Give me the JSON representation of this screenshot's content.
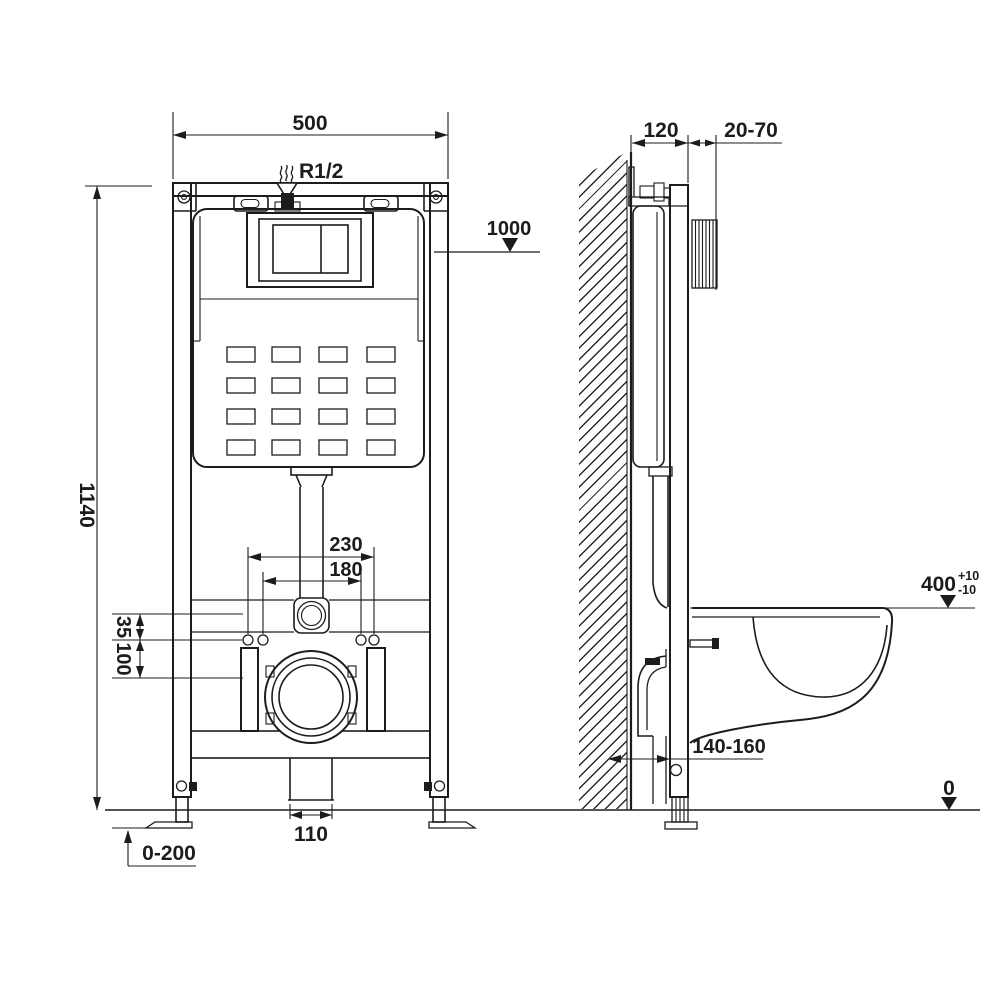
{
  "drawing": {
    "type": "installation-dimension-drawing",
    "subject": "wall-hung toilet concealed cistern frame",
    "front_view": {
      "dim_width": "500",
      "inlet_label": "R1/2",
      "level_label": "1000",
      "dim_height": "1140",
      "dim_rod_outer": "230",
      "dim_rod_inner": "180",
      "dim_offset_small": "35",
      "dim_offset_large": "100",
      "dim_drain_width": "110",
      "dim_foot_adjust": "0-200"
    },
    "side_view": {
      "dim_depth": "120",
      "dim_wall_offset": "20-70",
      "dim_bowl_height": "400",
      "bowl_height_tol_plus": "+10",
      "bowl_height_tol_minus": "-10",
      "dim_drain_offset": "140-160",
      "floor_level": "0"
    },
    "colors": {
      "line": "#1c1c1c",
      "background": "#ffffff"
    }
  }
}
